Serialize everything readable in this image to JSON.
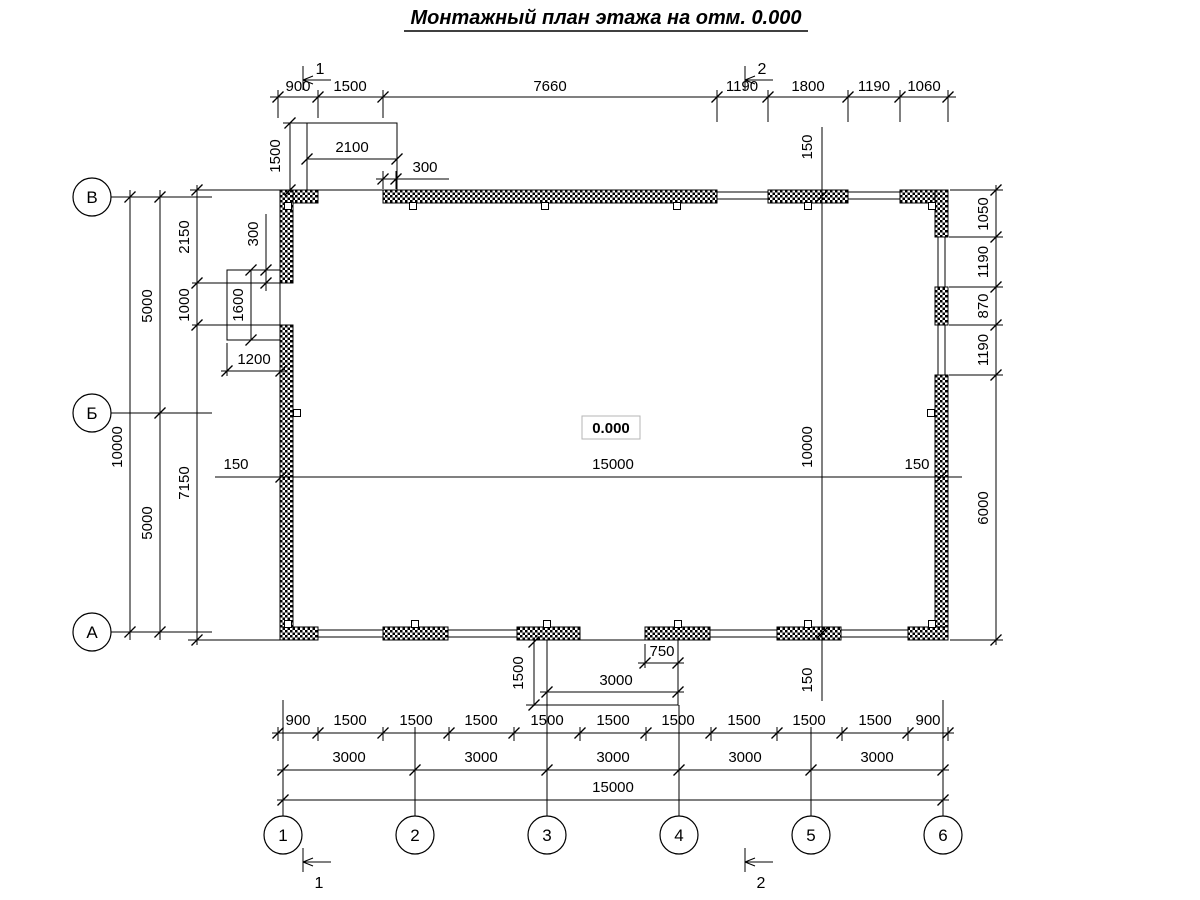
{
  "title": "Монтажный план этажа на отм. 0.000",
  "elevation": "0.000",
  "axes": {
    "rows": [
      "В",
      "Б",
      "А"
    ],
    "cols": [
      "1",
      "2",
      "3",
      "4",
      "5",
      "6"
    ]
  },
  "sections": {
    "one": "1",
    "two": "2"
  },
  "dims": {
    "top": [
      "900",
      "1500",
      "7660",
      "1190",
      "1800",
      "1190",
      "1060"
    ],
    "top_porch": {
      "height": "1500",
      "width": "2100",
      "wall": "300"
    },
    "left": {
      "total": "10000",
      "upper": "5000",
      "lower": "5000",
      "a": "2150",
      "b": "1000",
      "c": "7150"
    },
    "left_porch": {
      "wall": "300",
      "height": "1600",
      "width": "1200"
    },
    "right": [
      "1050",
      "1190",
      "870",
      "1190",
      "6000"
    ],
    "inner": {
      "width": "15000",
      "height": "10000",
      "off_left": "150",
      "off_right": "150",
      "off_top": "150",
      "off_bottom": "150"
    },
    "bottom_porch": {
      "height": "1500",
      "width": "3000",
      "part": "750"
    },
    "row1": [
      "900",
      "1500",
      "1500",
      "1500",
      "1500",
      "1500",
      "1500",
      "1500",
      "1500",
      "1500",
      "900"
    ],
    "row2": [
      "3000",
      "3000",
      "3000",
      "3000",
      "3000"
    ],
    "row3": "15000"
  }
}
